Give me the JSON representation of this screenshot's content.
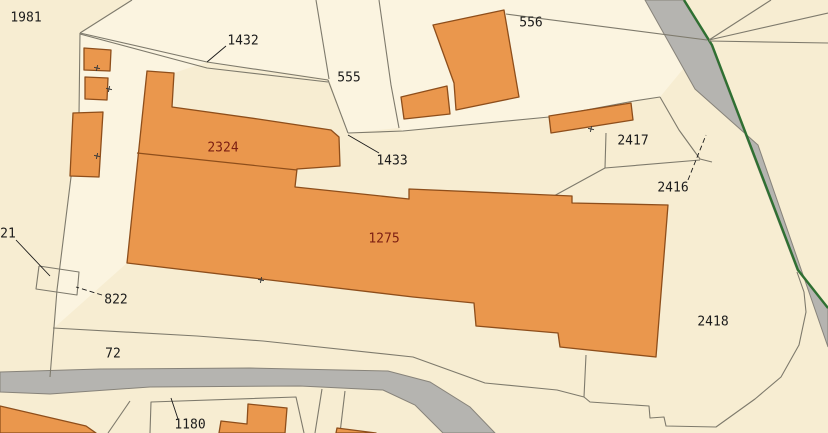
{
  "map": {
    "width": 828,
    "height": 433,
    "colors": {
      "base_parcel": "#f7edd2",
      "light_parcel": "#fbf4e0",
      "building_fill": "#ea974d",
      "building_stroke": "#8e4e1b",
      "road_fill": "#b5b4b0",
      "road_stroke": "#87837a",
      "green_edge": "#2f7032",
      "parcel_line": "#7e7a6c",
      "leader_line": "#1a1a1a",
      "tick_mark": "#3a3a3a",
      "parcel_label": "#1b1b1b",
      "building_label": "#7c1f12"
    },
    "labels": [
      {
        "text": "1981",
        "x": 26,
        "y": 18,
        "kind": "parcel"
      },
      {
        "text": "1432",
        "x": 243,
        "y": 41,
        "kind": "parcel"
      },
      {
        "text": "555",
        "x": 349,
        "y": 78,
        "kind": "parcel"
      },
      {
        "text": "556",
        "x": 531,
        "y": 23,
        "kind": "parcel"
      },
      {
        "text": "1433",
        "x": 392,
        "y": 161,
        "kind": "parcel"
      },
      {
        "text": "2417",
        "x": 633,
        "y": 141,
        "kind": "parcel"
      },
      {
        "text": "2416",
        "x": 673,
        "y": 188,
        "kind": "parcel"
      },
      {
        "text": "2418",
        "x": 713,
        "y": 322,
        "kind": "parcel"
      },
      {
        "text": "822",
        "x": 116,
        "y": 300,
        "kind": "parcel"
      },
      {
        "text": "72",
        "x": 113,
        "y": 354,
        "kind": "parcel"
      },
      {
        "text": "21",
        "x": 8,
        "y": 234,
        "kind": "parcel"
      },
      {
        "text": "1180",
        "x": 190,
        "y": 425,
        "kind": "parcel"
      },
      {
        "text": "2324",
        "x": 223,
        "y": 148,
        "kind": "building"
      },
      {
        "text": "1275",
        "x": 384,
        "y": 239,
        "kind": "building"
      }
    ],
    "light_parcels": [
      {
        "name": "parcel-1432",
        "points": [
          [
            80,
            33
          ],
          [
            132,
            0
          ],
          [
            316,
            0
          ],
          [
            329,
            79
          ],
          [
            207,
            62
          ]
        ]
      },
      {
        "name": "parcel-555",
        "points": [
          [
            316,
            0
          ],
          [
            379,
            0
          ],
          [
            391,
            85
          ],
          [
            399,
            128
          ],
          [
            348,
            133
          ],
          [
            329,
            79
          ]
        ]
      },
      {
        "name": "parcel-556",
        "points": [
          [
            379,
            0
          ],
          [
            645,
            0
          ],
          [
            707,
            40
          ],
          [
            660,
            97
          ],
          [
            634,
            101
          ],
          [
            549,
            117
          ],
          [
            403,
            131
          ],
          [
            399,
            128
          ],
          [
            391,
            85
          ]
        ]
      },
      {
        "name": "parcel-corridor",
        "points": [
          [
            80,
            33
          ],
          [
            207,
            62
          ],
          [
            174,
            73
          ],
          [
            147,
            71
          ],
          [
            127,
            263
          ],
          [
            55,
            327
          ],
          [
            57,
            290
          ],
          [
            71,
            177
          ],
          [
            79,
            115
          ]
        ]
      }
    ],
    "roads": [
      {
        "name": "road-diagonal",
        "points": [
          [
            645,
            0
          ],
          [
            683,
            0
          ],
          [
            711,
            45
          ],
          [
            797,
            270
          ],
          [
            828,
            309
          ],
          [
            828,
            347
          ],
          [
            758,
            145
          ],
          [
            695,
            89
          ]
        ]
      },
      {
        "name": "road-bottom",
        "points": [
          [
            0,
            372
          ],
          [
            100,
            369
          ],
          [
            250,
            368
          ],
          [
            388,
            371
          ],
          [
            430,
            382
          ],
          [
            470,
            407
          ],
          [
            495,
            433
          ],
          [
            443,
            433
          ],
          [
            415,
            405
          ],
          [
            383,
            390
          ],
          [
            300,
            386
          ],
          [
            150,
            387
          ],
          [
            50,
            394
          ],
          [
            0,
            392
          ]
        ]
      }
    ],
    "green_edges": [
      {
        "name": "road-green-edge",
        "points": [
          [
            684,
            0
          ],
          [
            712,
            45
          ],
          [
            798,
            270
          ],
          [
            828,
            308
          ]
        ]
      }
    ],
    "buildings": [
      {
        "name": "building-square-a",
        "points": [
          [
            84,
            48
          ],
          [
            111,
            50
          ],
          [
            110,
            71
          ],
          [
            84,
            70
          ]
        ]
      },
      {
        "name": "building-square-b",
        "points": [
          [
            85,
            77
          ],
          [
            108,
            78
          ],
          [
            107,
            100
          ],
          [
            85,
            99
          ]
        ]
      },
      {
        "name": "building-rect-c",
        "points": [
          [
            73,
            113
          ],
          [
            103,
            112
          ],
          [
            99,
            177
          ],
          [
            70,
            176
          ]
        ]
      },
      {
        "name": "building-complex-1275",
        "points": [
          [
            147,
            71
          ],
          [
            174,
            73
          ],
          [
            172,
            107
          ],
          [
            258,
            119
          ],
          [
            331,
            130
          ],
          [
            339,
            137
          ],
          [
            340,
            166
          ],
          [
            297,
            169
          ],
          [
            295,
            187
          ],
          [
            409,
            199
          ],
          [
            409,
            189
          ],
          [
            572,
            196
          ],
          [
            572,
            203
          ],
          [
            668,
            205
          ],
          [
            656,
            357
          ],
          [
            560,
            347
          ],
          [
            558,
            333
          ],
          [
            476,
            326
          ],
          [
            474,
            303
          ],
          [
            413,
            297
          ],
          [
            127,
            263
          ]
        ]
      },
      {
        "name": "building-556",
        "points": [
          [
            433,
            25
          ],
          [
            504,
            10
          ],
          [
            519,
            97
          ],
          [
            456,
            110
          ],
          [
            454,
            83
          ]
        ]
      },
      {
        "name": "building-small-556",
        "points": [
          [
            401,
            97
          ],
          [
            447,
            86
          ],
          [
            450,
            114
          ],
          [
            404,
            119
          ]
        ]
      },
      {
        "name": "building-thin-2417",
        "points": [
          [
            549,
            116
          ],
          [
            631,
            103
          ],
          [
            633,
            120
          ],
          [
            551,
            133
          ]
        ]
      },
      {
        "name": "building-bottom-left",
        "points": [
          [
            0,
            406
          ],
          [
            86,
            426
          ],
          [
            96,
            433
          ],
          [
            0,
            433
          ]
        ]
      },
      {
        "name": "building-1180-l",
        "points": [
          [
            248,
            404
          ],
          [
            287,
            408
          ],
          [
            285,
            433
          ],
          [
            219,
            433
          ],
          [
            221,
            421
          ],
          [
            247,
            424
          ]
        ]
      },
      {
        "name": "building-bottom-right-bit",
        "points": [
          [
            337,
            428
          ],
          [
            376,
            433
          ],
          [
            336,
            433
          ]
        ]
      }
    ],
    "building_divider": {
      "name": "divider-2324-1275",
      "points": [
        [
          137,
          153
        ],
        [
          297,
          170
        ]
      ]
    },
    "parcel_lines": [
      {
        "name": "line-topleft-a",
        "points": [
          [
            132,
            0
          ],
          [
            80,
            33
          ]
        ]
      },
      {
        "name": "line-left-vertical",
        "points": [
          [
            80,
            33
          ],
          [
            79,
            115
          ],
          [
            71,
            177
          ],
          [
            57,
            290
          ],
          [
            50,
            377
          ]
        ]
      },
      {
        "name": "line-north-1",
        "points": [
          [
            80,
            33
          ],
          [
            207,
            62
          ],
          [
            328,
            80
          ]
        ]
      },
      {
        "name": "line-north-2",
        "points": [
          [
            80,
            34
          ],
          [
            207,
            68
          ],
          [
            328,
            82
          ]
        ]
      },
      {
        "name": "line-junction-down",
        "points": [
          [
            328,
            80
          ],
          [
            348,
            133
          ]
        ]
      },
      {
        "name": "line-555-left",
        "points": [
          [
            316,
            0
          ],
          [
            329,
            79
          ]
        ]
      },
      {
        "name": "line-555-right",
        "points": [
          [
            379,
            0
          ],
          [
            391,
            85
          ],
          [
            399,
            128
          ]
        ]
      },
      {
        "name": "line-east-long",
        "points": [
          [
            348,
            133
          ],
          [
            403,
            131
          ],
          [
            549,
            117
          ],
          [
            634,
            101
          ],
          [
            660,
            97
          ]
        ]
      },
      {
        "name": "line-2416-north",
        "points": [
          [
            660,
            97
          ],
          [
            679,
            130
          ],
          [
            700,
            159
          ],
          [
            712,
            162
          ]
        ]
      },
      {
        "name": "line-2417-vert",
        "points": [
          [
            606,
            133
          ],
          [
            605,
            168
          ]
        ]
      },
      {
        "name": "line-2417-south",
        "points": [
          [
            552,
            197
          ],
          [
            605,
            168
          ],
          [
            700,
            160
          ]
        ]
      },
      {
        "name": "line-556-northeast",
        "points": [
          [
            506,
            14
          ],
          [
            707,
            40
          ]
        ]
      },
      {
        "name": "line-road-branch-up",
        "points": [
          [
            709,
            40
          ],
          [
            771,
            0
          ]
        ]
      },
      {
        "name": "line-road-branch-corner",
        "points": [
          [
            709,
            40
          ],
          [
            828,
            13
          ]
        ]
      },
      {
        "name": "line-road-branch-east",
        "points": [
          [
            709,
            41
          ],
          [
            828,
            43
          ]
        ]
      },
      {
        "name": "line-2418-boundary",
        "points": [
          [
            586,
            355
          ],
          [
            584,
            397
          ],
          [
            590,
            402
          ],
          [
            649,
            406
          ],
          [
            650,
            418
          ],
          [
            664,
            417
          ],
          [
            666,
            426
          ],
          [
            716,
            427
          ],
          [
            755,
            399
          ],
          [
            781,
            377
          ],
          [
            799,
            345
          ],
          [
            806,
            312
          ],
          [
            804,
            292
          ],
          [
            797,
            272
          ]
        ]
      },
      {
        "name": "line-south-of-building",
        "points": [
          [
            53,
            328
          ],
          [
            197,
            336
          ],
          [
            263,
            341
          ],
          [
            413,
            357
          ],
          [
            485,
            383
          ],
          [
            557,
            390
          ],
          [
            584,
            397
          ]
        ]
      },
      {
        "name": "line-bottom-left-diag",
        "points": [
          [
            130,
            401
          ],
          [
            108,
            433
          ]
        ]
      },
      {
        "name": "line-1180-parcel",
        "points": [
          [
            150,
            433
          ],
          [
            151,
            402
          ],
          [
            296,
            397
          ],
          [
            304,
            433
          ]
        ]
      },
      {
        "name": "line-bottom-vert-1",
        "points": [
          [
            322,
            389
          ],
          [
            315,
            433
          ]
        ]
      },
      {
        "name": "line-bottom-vert-2",
        "points": [
          [
            345,
            391
          ],
          [
            340,
            433
          ]
        ]
      },
      {
        "name": "square-822",
        "points": [
          [
            39,
            266
          ],
          [
            79,
            272
          ],
          [
            77,
            295
          ],
          [
            36,
            289
          ],
          [
            39,
            266
          ]
        ]
      }
    ],
    "leader_lines": [
      {
        "name": "leader-1432",
        "points": [
          [
            226,
            46
          ],
          [
            207,
            62
          ]
        ],
        "dashed": false
      },
      {
        "name": "leader-1433",
        "points": [
          [
            379,
            153
          ],
          [
            348,
            135
          ]
        ],
        "dashed": false
      },
      {
        "name": "leader-2416",
        "points": [
          [
            688,
            180
          ],
          [
            706,
            135
          ]
        ],
        "dashed": true
      },
      {
        "name": "leader-21",
        "points": [
          [
            16,
            240
          ],
          [
            50,
            276
          ]
        ],
        "dashed": false
      },
      {
        "name": "leader-822",
        "points": [
          [
            102,
            295
          ],
          [
            76,
            287
          ]
        ],
        "dashed": true
      },
      {
        "name": "leader-1180",
        "points": [
          [
            171,
            398
          ],
          [
            178,
            419
          ]
        ],
        "dashed": false
      }
    ],
    "survey_ticks": [
      {
        "x": 97,
        "y": 68
      },
      {
        "x": 109,
        "y": 89
      },
      {
        "x": 97,
        "y": 156
      },
      {
        "x": 261,
        "y": 280
      },
      {
        "x": 591,
        "y": 129
      }
    ]
  }
}
